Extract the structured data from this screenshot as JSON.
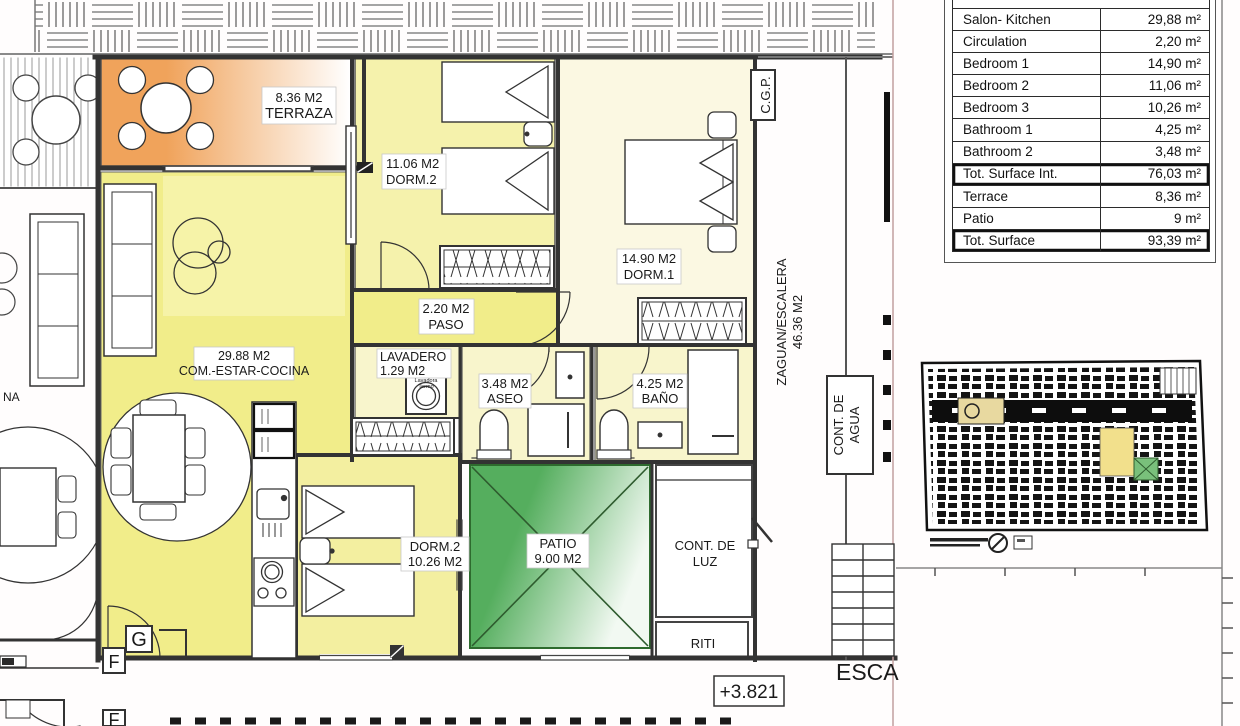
{
  "table": {
    "rows": [
      {
        "label": "Salon- Kitchen",
        "value": "29,88 m²"
      },
      {
        "label": "Circulation",
        "value": "2,20 m²"
      },
      {
        "label": "Bedroom 1",
        "value": "14,90 m²"
      },
      {
        "label": "Bedroom 2",
        "value": "11,06 m²"
      },
      {
        "label": "Bedroom 3",
        "value": "10,26 m²"
      },
      {
        "label": "Bathroom 1",
        "value": "4,25 m²"
      },
      {
        "label": "Bathroom 2",
        "value": "3,48 m²"
      },
      {
        "label": "Tot. Surface Int.",
        "value": "76,03 m²"
      },
      {
        "label": "Terrace",
        "value": "8,36 m²"
      },
      {
        "label": "Patio",
        "value": "9 m²"
      },
      {
        "label": "Tot. Surface",
        "value": "93,39 m²"
      }
    ]
  },
  "plan": {
    "rooms": {
      "terraza": {
        "l1": "8.36 M2",
        "l2": "TERRAZA"
      },
      "dorm2_top": {
        "l1": "11.06 M2",
        "l2": "DORM.2"
      },
      "dorm1": {
        "l1": "14.90 M2",
        "l2": "DORM.1"
      },
      "paso": {
        "l1": "2.20 M2",
        "l2": "PASO"
      },
      "salon": {
        "l1": "29.88 M2",
        "l2": "COM.-ESTAR-COCINA"
      },
      "lavadero": {
        "l1": "LAVADERO",
        "l2": "1.29 M2"
      },
      "aseo": {
        "l1": "3.48 M2",
        "l2": "ASEO"
      },
      "bano": {
        "l1": "4.25 M2",
        "l2": "BAÑO"
      },
      "dorm2_bottom": {
        "l1": "DORM.2",
        "l2": "10.26 M2"
      },
      "patio": {
        "l1": "PATIO",
        "l2": "9.00 M2"
      },
      "cont_luz": {
        "l1": "CONT. DE",
        "l2": "LUZ"
      },
      "riti": {
        "l1": "RITI"
      },
      "zaguan": {
        "l1": "ZAGUAN/ESCALERA",
        "l2": "46.36 M2"
      },
      "cont_agua": {
        "l1": "CONT. DE",
        "l2": "AGUA"
      },
      "cgp": {
        "l1": "C.G.P."
      }
    },
    "annotations": {
      "level": "+3.821",
      "esca": "ESCA",
      "grid_g": "G",
      "grid_f": "F",
      "grid_f2": "F",
      "neighbor_fragment": "NA"
    },
    "fixtures": {
      "washer_l1": "Lavadora",
      "washer_l2": "Termo"
    }
  },
  "colors": {
    "living": "#f1ed8a",
    "rug": "#f6f3a8",
    "dorm_top": "#f5f2ac",
    "dorm1": "#fbf8e2",
    "bath": "#f8f5cc",
    "dorm_bottom": "#f3efa0",
    "patio_green": "#55ae5e",
    "patio_fade": "#f2f9f2",
    "terrace_orange": "#f0a35b",
    "wall": "#333333"
  }
}
